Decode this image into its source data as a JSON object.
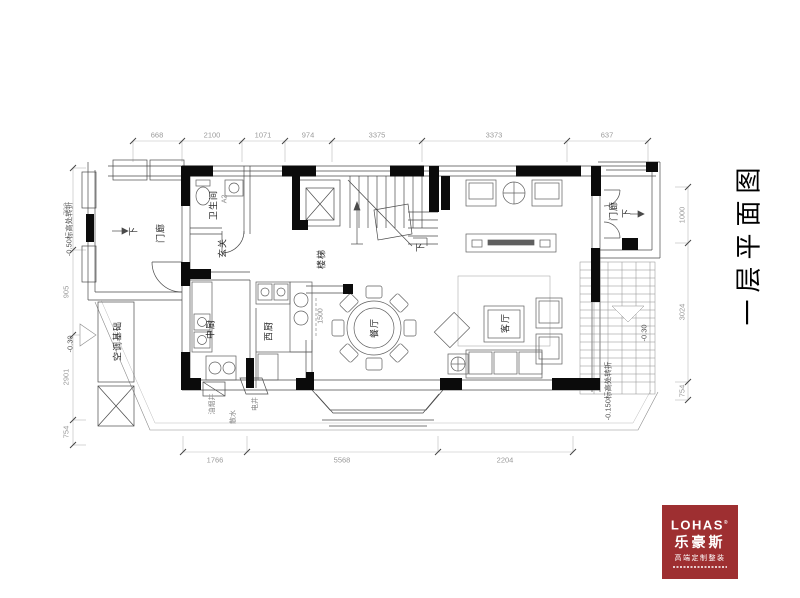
{
  "title": {
    "text": "一层平面图"
  },
  "logo": {
    "brand": "LOHAS",
    "reg": "®",
    "name_cn": "乐豪斯",
    "tagline": "高端定制整装",
    "bg_color": "#9e2f31"
  },
  "rooms": {
    "porch_left": "门廊",
    "bathroom": "卫生间",
    "bathroom_code": "A2",
    "entry": "玄关",
    "stairs": "楼梯",
    "kitchen_chinese": "中厨",
    "kitchen_western": "西厨",
    "dining": "餐厅",
    "living": "客厅",
    "porch_right": "门廊",
    "ac_base": "空调基础",
    "oil_flue_shaft": "油烟井",
    "electric_shaft": "电井",
    "apron": "散水"
  },
  "annotations": {
    "down_porch_left": "下",
    "down_stairs": "下",
    "down_porch_right": "下",
    "level_note_left": "-0.50标高处转折",
    "level_note_right": "-0.150标高处转折",
    "elevation_left": "-0.30",
    "elevation_right": "-0.30",
    "counter_note": "1500"
  },
  "dimensions": {
    "top": [
      "668",
      "2100",
      "1071",
      "974",
      "3375",
      "3373",
      "637"
    ],
    "bottom": [
      "1766",
      "5568",
      "2204"
    ],
    "left": [
      "798",
      "905",
      "2901",
      "754"
    ],
    "right": [
      "1000",
      "3024",
      "754"
    ]
  }
}
